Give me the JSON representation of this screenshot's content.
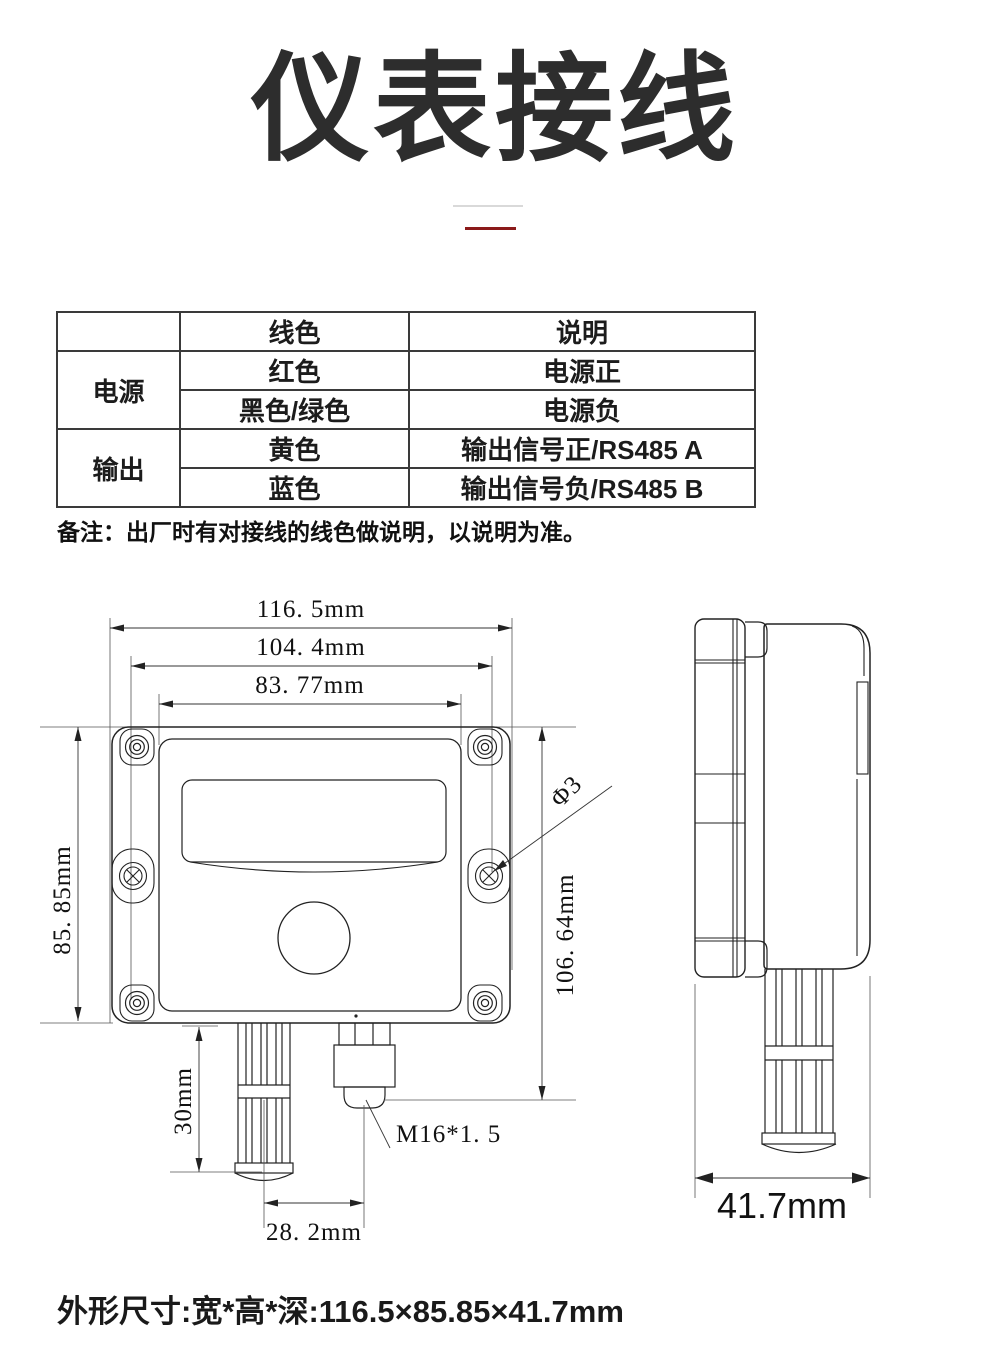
{
  "title": "仪表接线",
  "table": {
    "header": {
      "col2": "线色",
      "col3": "说明"
    },
    "groups": [
      {
        "label": "电源",
        "rows": [
          {
            "color": "红色",
            "desc": "电源正"
          },
          {
            "color": "黑色/绿色",
            "desc": "电源负"
          }
        ]
      },
      {
        "label": "输出",
        "rows": [
          {
            "color": "黄色",
            "desc": "输出信号正/RS485 A"
          },
          {
            "color": "蓝色",
            "desc": "输出信号负/RS485 B"
          }
        ]
      }
    ]
  },
  "note": "备注：出厂时有对接线的线色做说明，以说明为准。",
  "dimensions": {
    "front": {
      "width_outer": "116. 5mm",
      "width_mount": "104. 4mm",
      "width_lid": "83. 77mm",
      "height_body": "85. 85mm",
      "height_total": "106. 64mm",
      "probe_length": "30mm",
      "probe_offset": "28. 2mm",
      "hole": "Φ3",
      "gland": "M16*1. 5"
    },
    "side": {
      "depth": "41.7mm"
    }
  },
  "footer": "外形尺寸:宽*高*深:116.5×85.85×41.7mm",
  "colors": {
    "accent_red": "#8b1a1a",
    "divider_gray": "#d9d9d9",
    "line": "#222222"
  }
}
